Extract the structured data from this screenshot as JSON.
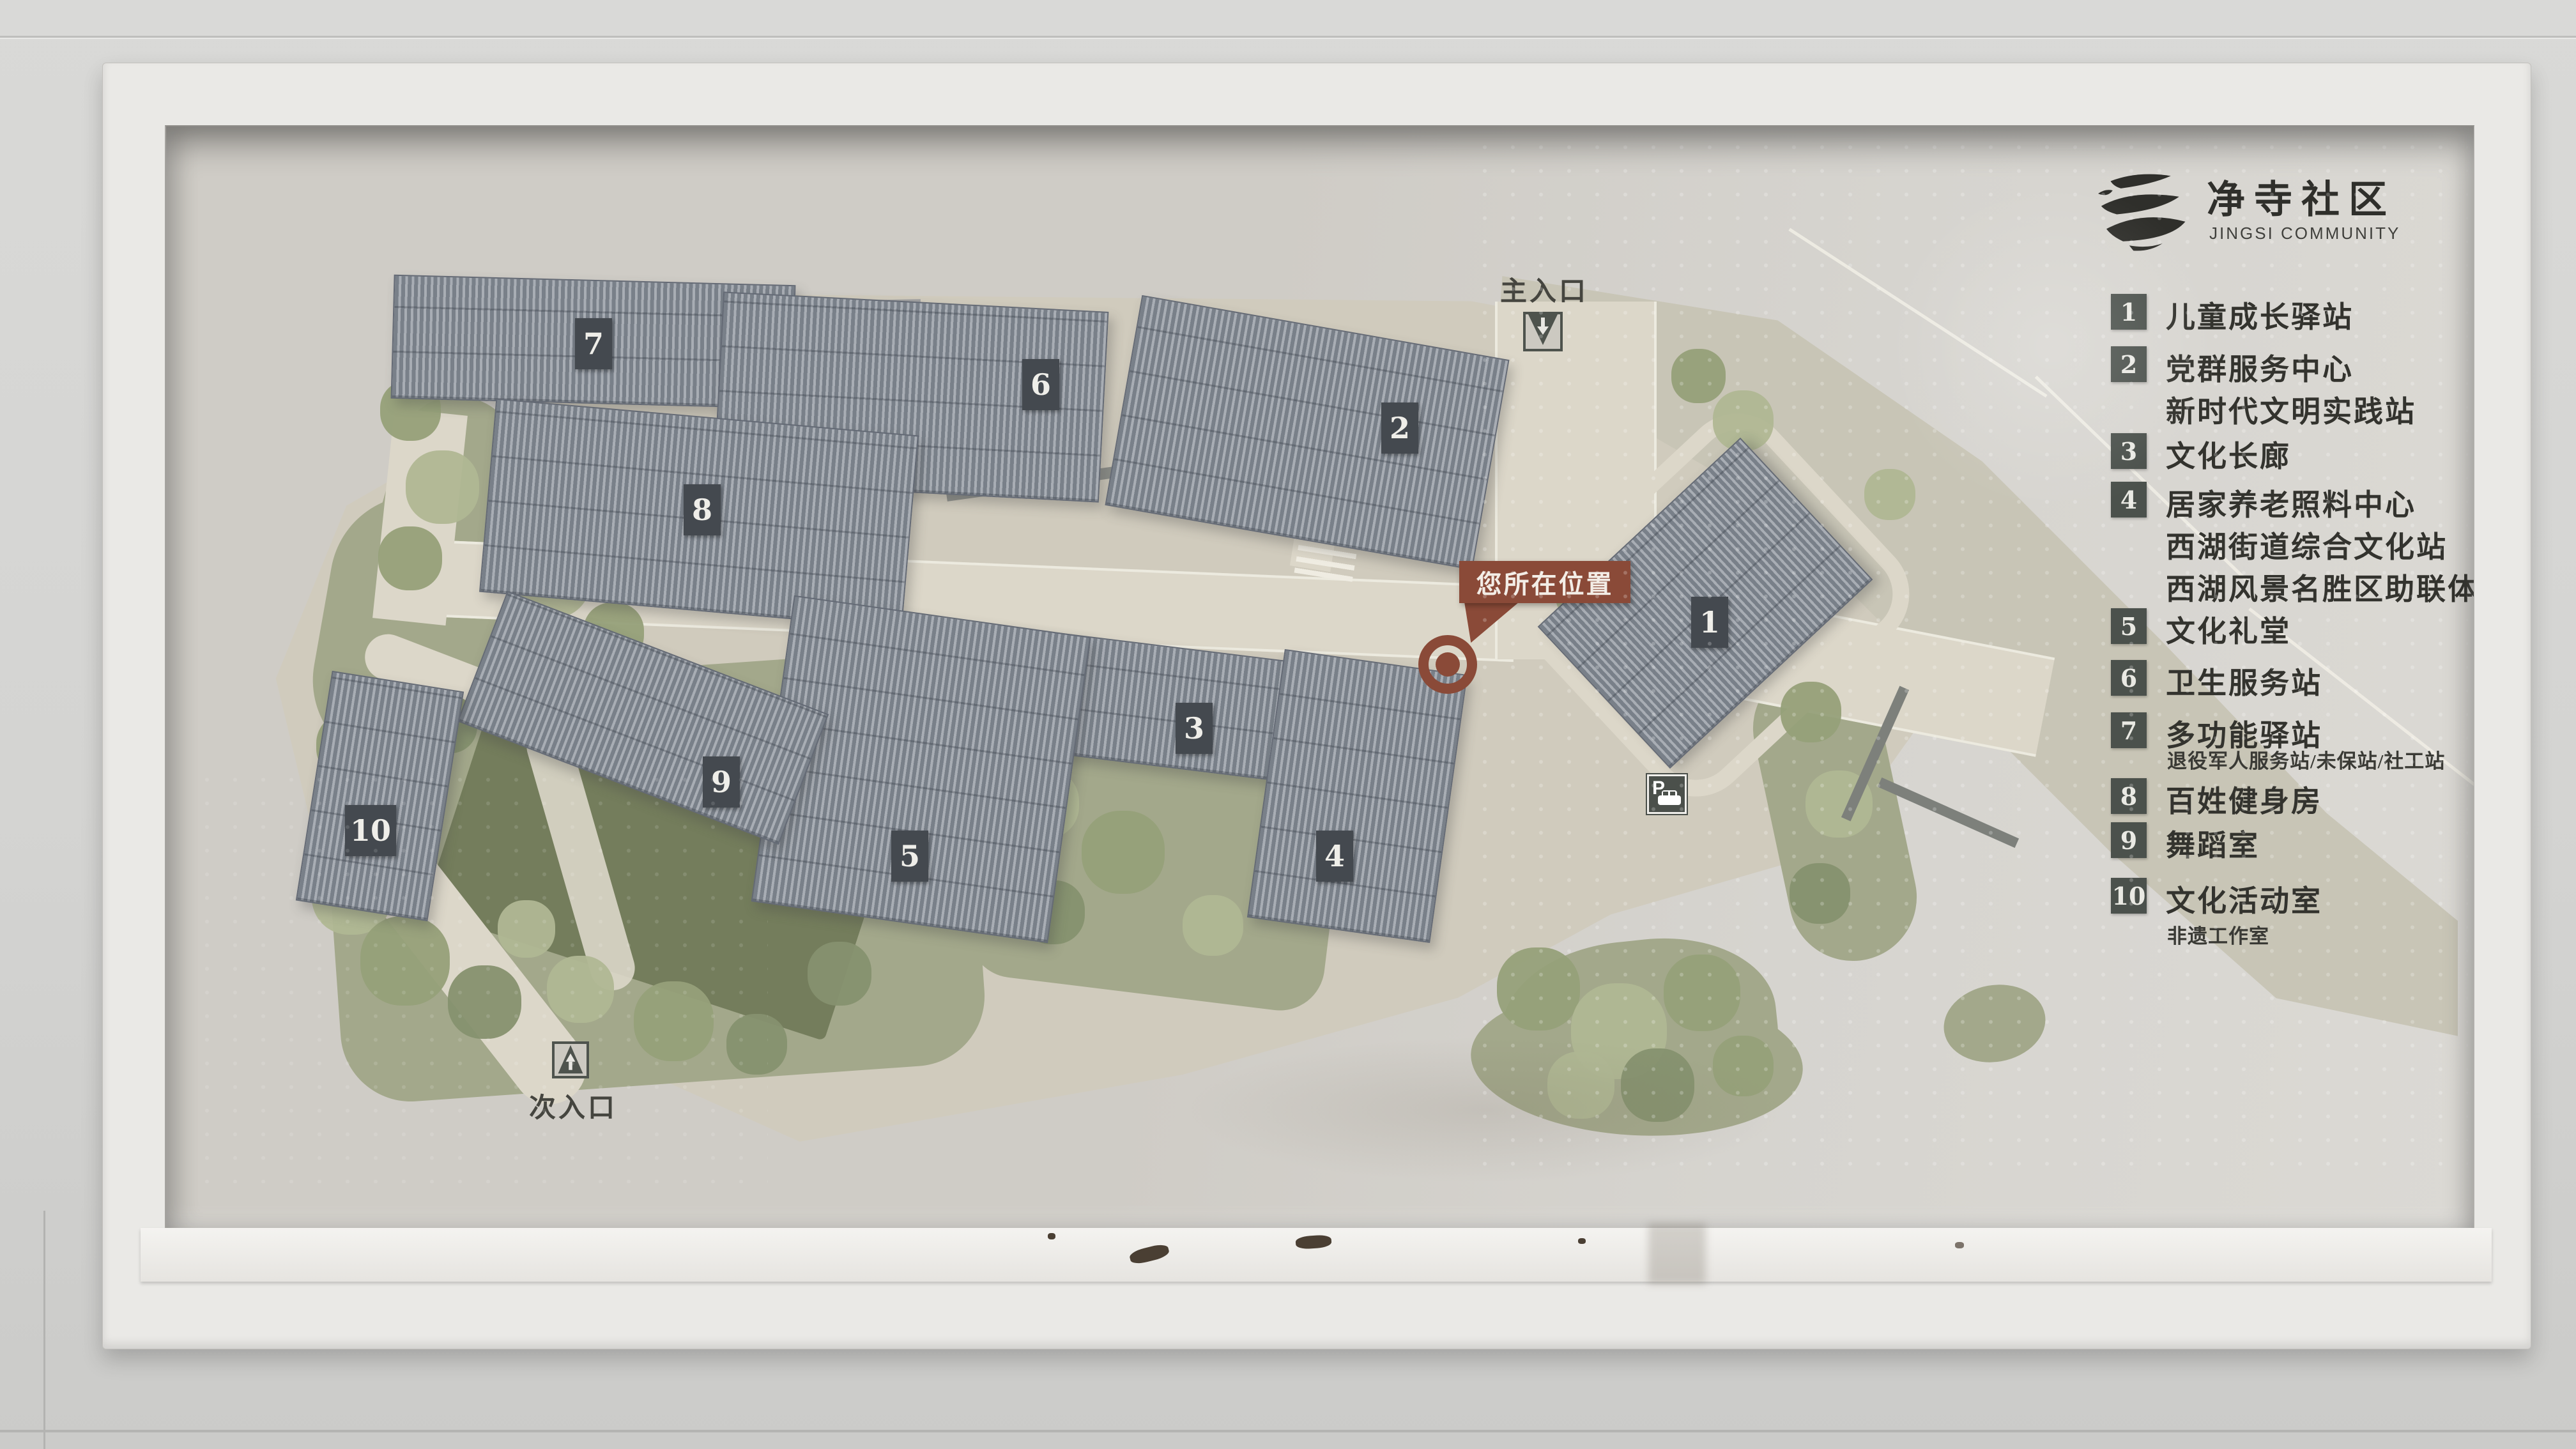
{
  "logo": {
    "title": "净寺社区",
    "subtitle": "JINGSI COMMUNITY"
  },
  "map": {
    "labels": {
      "main_entrance": "主入口",
      "secondary_entrance": "次入口",
      "you_are_here": "您所在位置",
      "parking_symbol": "P"
    },
    "buildings": [
      {
        "number": "1"
      },
      {
        "number": "2"
      },
      {
        "number": "3"
      },
      {
        "number": "4"
      },
      {
        "number": "5"
      },
      {
        "number": "6"
      },
      {
        "number": "7"
      },
      {
        "number": "8"
      },
      {
        "number": "9"
      },
      {
        "number": "10"
      }
    ]
  },
  "legend": {
    "items": [
      {
        "num": "1",
        "lines": [
          "儿童成长驿站"
        ],
        "sub": ""
      },
      {
        "num": "2",
        "lines": [
          "党群服务中心",
          "新时代文明实践站"
        ],
        "sub": ""
      },
      {
        "num": "3",
        "lines": [
          "文化长廊"
        ],
        "sub": ""
      },
      {
        "num": "4",
        "lines": [
          "居家养老照料中心",
          "西湖街道综合文化站",
          "西湖风景名胜区助联体"
        ],
        "sub": ""
      },
      {
        "num": "5",
        "lines": [
          "文化礼堂"
        ],
        "sub": ""
      },
      {
        "num": "6",
        "lines": [
          "卫生服务站"
        ],
        "sub": ""
      },
      {
        "num": "7",
        "lines": [
          "多功能驿站"
        ],
        "sub": "退役军人服务站/未保站/社工站"
      },
      {
        "num": "8",
        "lines": [
          "百姓健身房"
        ],
        "sub": ""
      },
      {
        "num": "9",
        "lines": [
          "舞蹈室"
        ],
        "sub": ""
      },
      {
        "num": "10",
        "lines": [
          "文化活动室"
        ],
        "sub": "非遗工作室"
      }
    ]
  },
  "colors": {
    "marker": "#8a4a38",
    "building_fill": "#a8adb4",
    "building_stripe": "#798089",
    "plate_bg": "#44494f",
    "legend_square_bg": "#4b514c",
    "site_ground": "#d0cbbd",
    "road": "#dcd7c9",
    "sweep_road": "#c8c5b6",
    "green": "#a3a88b",
    "dark_green": "#747d5c",
    "panel_bg": "#cfccc6",
    "frame": "#eae9e6",
    "wall": "#d4d4d2"
  }
}
